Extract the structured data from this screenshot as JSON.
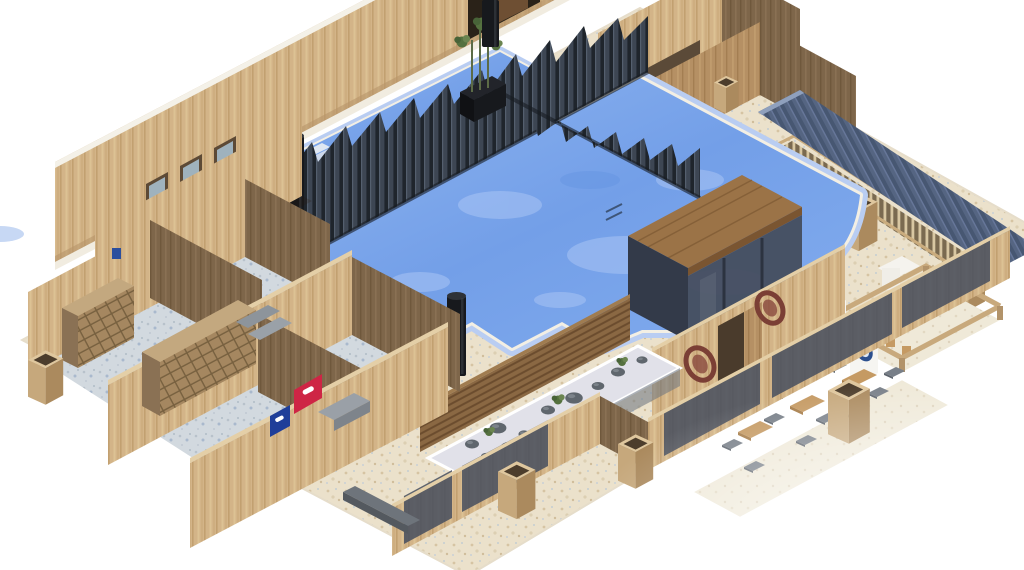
{
  "scene": {
    "description": "3D isometric architectural render of a spa and swimming-pool facility floor plan, roof removed, on a white background",
    "view": "axonometric cutaway",
    "background": "#ffffff"
  },
  "colors": {
    "floor": "#ebe1cb",
    "floorSpeckle": "#d6c4a3",
    "lockerFloor": "#d2d9df",
    "water": "#739fe8",
    "waterLight": "#8fb5f0",
    "tileBand": "#b9cdf2",
    "coping": "#f3efe4",
    "woodLight": "#d3b488",
    "woodMid": "#b59064",
    "woodDark": "#7e664a",
    "woodCap": "#e4cfa7",
    "slat": "#3d4653",
    "slatGap": "#1f252c",
    "corrugatedRoof": "#556582",
    "cabanaRoof": "#9b7347",
    "glass": "#454d5e",
    "gravel": "#e1e1e9",
    "rock": "#5f666d",
    "plant": "#55713f",
    "column": "#17191d",
    "bench": "#8d949b",
    "bannerRed": "#ce2545",
    "bannerBlue": "#1f3e99",
    "table": "#c59a63",
    "chair": "#787f88",
    "mirror": "#9fb2bd",
    "signRing": "#7b3f35",
    "ovalBlue": "#2b4f8e",
    "white": "#ffffff"
  },
  "regions": {
    "mainPool": "main swimming pool",
    "lapPool": "upper lap pool with steps",
    "slatScreen": "dark vertical-slat privacy screens crossing the pool",
    "vanity": "wash basins with three mirrors",
    "lockerRooms": "locker / changing rooms",
    "rockGarden": "zen rock garden strip",
    "terrace": "seating terrace with tables",
    "kitchen": "open-frame kitchen bar",
    "cabana": "glass cabana with flat wood roof",
    "colonnade": "colonnade walkway with corrugated roof"
  },
  "props": {
    "mirrors": 3,
    "vanityStools": 3,
    "lockerBanks": 2,
    "blackColumns": 3,
    "terraceTables": 3,
    "terraceChairs": 10,
    "ovalWallSigns": 2,
    "banners": [
      "red",
      "blue"
    ],
    "kitchenDoors": 2
  }
}
